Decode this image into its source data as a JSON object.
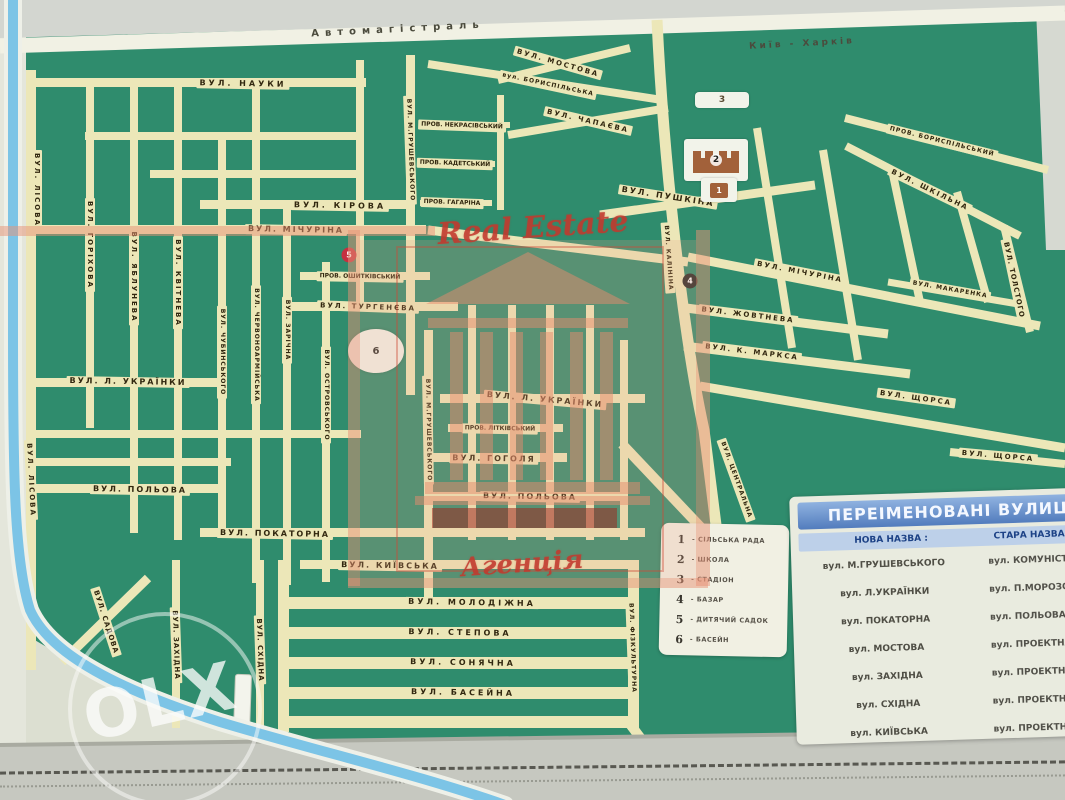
{
  "map": {
    "highway_label": "Автомагістраль",
    "highway_direction": "Київ - Харків",
    "streets": [
      {
        "t": "Автомагістраль",
        "x": 398,
        "y": 30,
        "r": -3,
        "s": 10,
        "ls": 6,
        "nobg": true
      },
      {
        "t": "Київ - Харків",
        "x": 802,
        "y": 44,
        "r": -3,
        "s": 9,
        "ls": 3,
        "nobg": true
      },
      {
        "t": "ВУЛ. МОСТОВА",
        "x": 558,
        "y": 63,
        "r": 16,
        "s": 7,
        "ls": 2
      },
      {
        "t": "вул. БОРИСПІЛЬСЬКА",
        "x": 548,
        "y": 85,
        "r": 12,
        "s": 6,
        "ls": 1
      },
      {
        "t": "ВУЛ. НАУКИ",
        "x": 243,
        "y": 84,
        "r": 1,
        "s": 8,
        "ls": 3
      },
      {
        "t": "ВУЛ. ЧАПАЄВА",
        "x": 588,
        "y": 121,
        "r": 13,
        "s": 7,
        "ls": 2
      },
      {
        "t": "ПРОВ. БОРИСПІЛЬСЬКИЙ",
        "x": 942,
        "y": 142,
        "r": 14,
        "s": 6,
        "ls": 1
      },
      {
        "t": "ВУЛ. ШКІЛЬНА",
        "x": 930,
        "y": 190,
        "r": 26,
        "s": 7,
        "ls": 2
      },
      {
        "t": "ПРОВ. НЕКРАСІВСЬКИЙ",
        "x": 462,
        "y": 126,
        "r": 2,
        "s": 6
      },
      {
        "t": "ПРОВ. КАДЕТСЬКИЙ",
        "x": 455,
        "y": 164,
        "r": 2,
        "s": 6
      },
      {
        "t": "ПРОВ. ГАГАРІНА",
        "x": 452,
        "y": 203,
        "r": 2,
        "s": 6
      },
      {
        "t": "ВУЛ. КІРОВА",
        "x": 340,
        "y": 206,
        "r": 1,
        "s": 8,
        "ls": 3
      },
      {
        "t": "ВУЛ. МІЧУРІНА",
        "x": 296,
        "y": 230,
        "r": 1,
        "s": 8,
        "ls": 2
      },
      {
        "t": "ВУЛ. ПУШКІНА",
        "x": 668,
        "y": 197,
        "r": 9,
        "s": 8,
        "ls": 2
      },
      {
        "t": "ВУЛ. МІЧУРІНА",
        "x": 800,
        "y": 272,
        "r": 11,
        "s": 7,
        "ls": 2
      },
      {
        "t": "ВУЛ. МАКАРЕНКА",
        "x": 950,
        "y": 290,
        "r": 10,
        "s": 6,
        "ls": 1
      },
      {
        "t": "ВУЛ. ТОЛСТОГО",
        "x": 1014,
        "y": 280,
        "r": 78,
        "s": 7,
        "ls": 1
      },
      {
        "t": "ВУЛ. ЖОВТНЕВА",
        "x": 748,
        "y": 315,
        "r": 7,
        "s": 7,
        "ls": 2
      },
      {
        "t": "ВУЛ. К. МАРКСА",
        "x": 752,
        "y": 352,
        "r": 7,
        "s": 7,
        "ls": 2
      },
      {
        "t": "ВУЛ. ЩОРСА",
        "x": 916,
        "y": 398,
        "r": 8,
        "s": 7,
        "ls": 2
      },
      {
        "t": "ВУЛ. ЩОРСА",
        "x": 998,
        "y": 456,
        "r": 5,
        "s": 7,
        "ls": 2
      },
      {
        "t": "ПРОВ. ОШИТКІВСЬКИЙ",
        "x": 360,
        "y": 277,
        "r": 1,
        "s": 6
      },
      {
        "t": "ВУЛ. ТУРГЕНЄВА",
        "x": 368,
        "y": 307,
        "r": 2,
        "s": 7,
        "ls": 2
      },
      {
        "t": "ВУЛ. Л. УКРАЇНКИ",
        "x": 128,
        "y": 382,
        "r": 1,
        "s": 8,
        "ls": 2
      },
      {
        "t": "ВУЛ. Л. УКРАЇНКИ",
        "x": 545,
        "y": 400,
        "r": 5,
        "s": 8,
        "ls": 2
      },
      {
        "t": "ПРОВ. ЛІТКІВСЬКИЙ",
        "x": 500,
        "y": 429,
        "r": 1,
        "s": 6
      },
      {
        "t": "ВУЛ. ГОГОЛЯ",
        "x": 494,
        "y": 459,
        "r": 1,
        "s": 8,
        "ls": 2
      },
      {
        "t": "ВУЛ. ПОЛЬОВА",
        "x": 140,
        "y": 490,
        "r": 1,
        "s": 8,
        "ls": 2
      },
      {
        "t": "ВУЛ. ПОЛЬОВА",
        "x": 530,
        "y": 497,
        "r": 1,
        "s": 8,
        "ls": 2
      },
      {
        "t": "ВУЛ. ПОКАТОРНА",
        "x": 275,
        "y": 534,
        "r": 1,
        "s": 8,
        "ls": 2
      },
      {
        "t": "ВУЛ. КИЇВСЬКА",
        "x": 390,
        "y": 566,
        "r": 1,
        "s": 8,
        "ls": 2
      },
      {
        "t": "ВУЛ. МОЛОДІЖНА",
        "x": 472,
        "y": 603,
        "r": 1,
        "s": 8,
        "ls": 3
      },
      {
        "t": "ВУЛ. СТЕПОВА",
        "x": 460,
        "y": 633,
        "r": 1,
        "s": 8,
        "ls": 3
      },
      {
        "t": "ВУЛ. СОНЯЧНА",
        "x": 463,
        "y": 663,
        "r": 1,
        "s": 8,
        "ls": 3
      },
      {
        "t": "ВУЛ. БАСЕЙНА",
        "x": 463,
        "y": 693,
        "r": 1,
        "s": 8,
        "ls": 3
      },
      {
        "t": "ВУЛ. ЛІСОВА",
        "x": 37,
        "y": 190,
        "r": 90,
        "s": 7,
        "ls": 2
      },
      {
        "t": "ВУЛ. ЛІСОВА",
        "x": 31,
        "y": 480,
        "r": 87,
        "s": 7,
        "ls": 2
      },
      {
        "t": "ВУЛ. ГОРІХОВА",
        "x": 90,
        "y": 245,
        "r": 90,
        "s": 7,
        "ls": 2
      },
      {
        "t": "ВУЛ. ЯБЛУНЕВА",
        "x": 134,
        "y": 277,
        "r": 90,
        "s": 7,
        "ls": 2
      },
      {
        "t": "ВУЛ. КВІТНЕВА",
        "x": 178,
        "y": 283,
        "r": 90,
        "s": 7,
        "ls": 2
      },
      {
        "t": "ВУЛ. ЧУБИНСЬКОГО",
        "x": 222,
        "y": 352,
        "r": 90,
        "s": 6,
        "ls": 1
      },
      {
        "t": "ВУЛ. ЧЕРВОНОАРМІЙСЬКА",
        "x": 256,
        "y": 345,
        "r": 90,
        "s": 6,
        "ls": 1
      },
      {
        "t": "ВУЛ. ЗАРІЧНА",
        "x": 287,
        "y": 330,
        "r": 90,
        "s": 6,
        "ls": 1
      },
      {
        "t": "ВУЛ. ОСТРОВСЬКОГО",
        "x": 326,
        "y": 395,
        "r": 90,
        "s": 6,
        "ls": 1
      },
      {
        "t": "ВУЛ. М.ГРУШЕВСЬКОГО",
        "x": 410,
        "y": 150,
        "r": 88,
        "s": 6,
        "ls": 1
      },
      {
        "t": "ВУЛ. М.ГРУШЕВСЬКОГО",
        "x": 428,
        "y": 430,
        "r": 89,
        "s": 6,
        "ls": 1
      },
      {
        "t": "ВУЛ. КАЛІНІНА",
        "x": 668,
        "y": 258,
        "r": 86,
        "s": 6,
        "ls": 1
      },
      {
        "t": "ВУЛ. ЦЕНТРАЛЬНА",
        "x": 736,
        "y": 480,
        "r": 70,
        "s": 6,
        "ls": 1
      },
      {
        "t": "ВУЛ. САДОВА",
        "x": 106,
        "y": 622,
        "r": 72,
        "s": 7,
        "ls": 1
      },
      {
        "t": "ВУЛ. ЗАХІДНА",
        "x": 176,
        "y": 645,
        "r": 88,
        "s": 7,
        "ls": 1
      },
      {
        "t": "ВУЛ. СХІДНА",
        "x": 260,
        "y": 650,
        "r": 88,
        "s": 7,
        "ls": 1
      },
      {
        "t": "ВУЛ. ФІЗКУЛЬТУРНА",
        "x": 632,
        "y": 648,
        "r": 88,
        "s": 6,
        "ls": 1
      }
    ]
  },
  "markers": [
    {
      "num": "3",
      "kind": "pill",
      "x": 722,
      "y": 100
    },
    {
      "num": "2",
      "kind": "school",
      "x": 716,
      "y": 160
    },
    {
      "num": "1",
      "kind": "box",
      "x": 719,
      "y": 190
    },
    {
      "num": "4",
      "kind": "dot-dark",
      "x": 690,
      "y": 281
    },
    {
      "num": "5",
      "kind": "dot-red",
      "x": 349,
      "y": 255
    },
    {
      "num": "6",
      "kind": "ellipse",
      "x": 376,
      "y": 351
    }
  ],
  "legend": {
    "items": [
      {
        "num": "1",
        "label": "СІЛЬСЬКА РАДА"
      },
      {
        "num": "2",
        "label": "ШКОЛА"
      },
      {
        "num": "3",
        "label": "СТАДІОН"
      },
      {
        "num": "4",
        "label": "БАЗАР"
      },
      {
        "num": "5",
        "label": "ДИТЯЧИЙ САДОК"
      },
      {
        "num": "6",
        "label": "БАСЕЙН"
      }
    ]
  },
  "renamed_table": {
    "title": "ПЕРЕІМЕНОВАНІ ВУЛИЦІ",
    "col_new": "НОВА НАЗВА :",
    "col_old": "СТАРА НАЗВА",
    "rows": [
      {
        "new_name": "вул. М.ГРУШЕВСЬКОГО",
        "old_name": "вул. КОМУНІСТИЧНА"
      },
      {
        "new_name": "вул. Л.УКРАЇНКИ",
        "old_name": "вул. П.МОРОЗОВА"
      },
      {
        "new_name": "вул. ПОКАТОРНА",
        "old_name": "вул. ПОЛЬОВА"
      },
      {
        "new_name": "вул. МОСТОВА",
        "old_name": "вул. ПРОЕКТНА"
      },
      {
        "new_name": "вул. ЗАХІДНА",
        "old_name": "вул. ПРОЕКТНА"
      },
      {
        "new_name": "вул. СХІДНА",
        "old_name": "вул. ПРОЕКТНА"
      },
      {
        "new_name": "вул. КИЇВСЬКА",
        "old_name": "вул. ПРОЕКТНА"
      }
    ]
  },
  "watermarks": {
    "agency_line1": "Real Estate",
    "agency_line2": "Агенція",
    "olx": "OLX"
  }
}
